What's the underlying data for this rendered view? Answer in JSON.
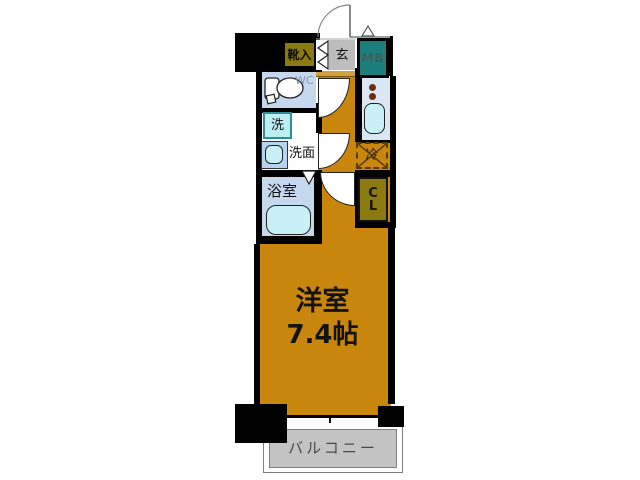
{
  "colors": {
    "wall": "#000000",
    "room_orange": "#c8860d",
    "olive": "#8a7a10",
    "teal": "#1d7f7c",
    "entry_gray": "#bdbdbd",
    "step_tan": "#d3a040",
    "balcony_gray": "#c3c3c3",
    "pale_blue": "#c5d8ee",
    "kitchen_blue": "#dbe6f4",
    "fixture_cyan": "#c9f0f7",
    "washer_border": "#2e8f9b",
    "fridge_dash": "#5d3a0a"
  },
  "rooms": {
    "shoe_storage": {
      "label": "靴入"
    },
    "entrance": {
      "label": "玄"
    },
    "meter_box": {
      "label": "MB"
    },
    "toilet": {
      "label": "WC"
    },
    "washer": {
      "label": "洗"
    },
    "washroom": {
      "label": "洗面"
    },
    "bathroom": {
      "label": "浴室"
    },
    "refrigerator": {
      "label": "冷"
    },
    "closet": {
      "label_top": "C",
      "label_bottom": "L"
    },
    "main_room": {
      "label": "洋室",
      "size": "7.4帖"
    },
    "balcony": {
      "label": "バルコニー"
    }
  }
}
